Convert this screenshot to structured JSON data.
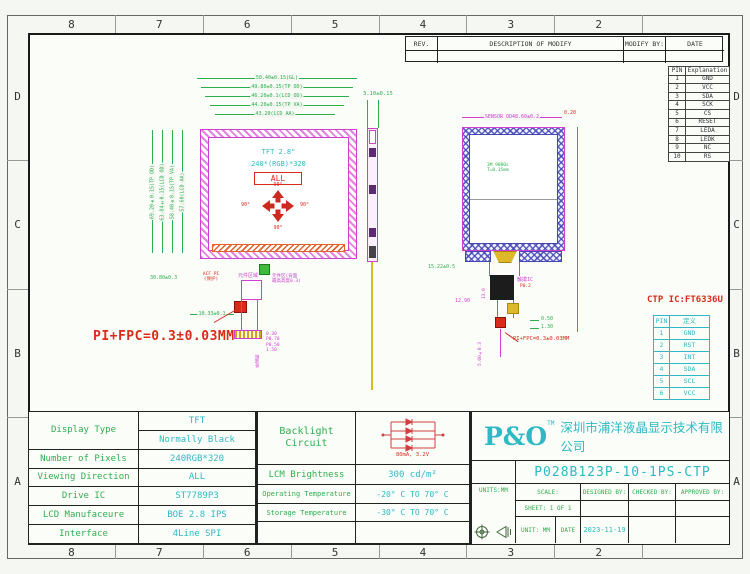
{
  "frame": {
    "zones_top": [
      "8",
      "7",
      "6",
      "5",
      "4",
      "3",
      "2",
      ""
    ],
    "zones_bottom": [
      "8",
      "7",
      "6",
      "5",
      "4",
      "3",
      "2",
      ""
    ],
    "zones_left": [
      "D",
      "C",
      "B",
      "A"
    ],
    "zones_right": [
      "D",
      "C",
      "B",
      "A"
    ]
  },
  "revision_table": {
    "col_rev": "REV.",
    "col_desc": "DESCRIPTION OF MODIFY",
    "col_by": "MODIFY BY:",
    "col_date": "DATE"
  },
  "pin_table": {
    "col_pin": "PIN",
    "col_exp": "Explanation",
    "rows": [
      [
        "1",
        "GND"
      ],
      [
        "2",
        "VCC"
      ],
      [
        "3",
        "SDA"
      ],
      [
        "4",
        "SCK"
      ],
      [
        "5",
        "CS"
      ],
      [
        "6",
        "RESET"
      ],
      [
        "7",
        "LEDA"
      ],
      [
        "8",
        "LEDK"
      ],
      [
        "9",
        "NC"
      ],
      [
        "10",
        "RS"
      ]
    ]
  },
  "front_view": {
    "h_dims": [
      "50.40±0.15(GL)",
      "49.80±0.15(TP OD)",
      "46.20±0.1(LCD OD)",
      "44.20±0.15(TP VA)",
      "43.20(LCD AA)"
    ],
    "v_dims": [
      "69.20±0.15(TP OD)",
      "63.84±0.15(LCD OD)",
      "58.40±0.15(TP VA)",
      "57.60(LCD AA)"
    ],
    "panel_type": "TFT 2.8\"",
    "resolution": "240*(RGB)*320",
    "viewing_badge": "ALL",
    "angle_top": "90°",
    "angle_bottom": "90°",
    "angle_left": "90°",
    "angle_right": "90°",
    "dim_fpc": "10.33±0.1",
    "dim_side": "30.80±0.3",
    "label_acf_line1": "ACF PI",
    "label_acf_line2": "(保护)",
    "label_comp_area": "元件区域",
    "label_comp_back_line1": "元件区(背面",
    "label_comp_back_line2": "最高高度0.3)",
    "label_stiffener": "补强板",
    "fpc_pitch_dims": [
      "0.30",
      "P0.70",
      "P0.50",
      "1.50"
    ],
    "note_pi_fpc": "PI+FPC=0.3±0.03MM"
  },
  "side_view": {
    "dim_thickness": "3.10±0.15"
  },
  "back_view": {
    "dim_sensor": "SENSOR OD48.60±0.2",
    "dim_corner": "0.20",
    "tape_line1": "3M 9080s",
    "tape_line2": "T=0.15mm",
    "dim_fpc_width": "15.22±0.5",
    "dim_ic_height": "13.0",
    "dim_1290": "12.90",
    "label_touch_ic": "触摸IC",
    "dim_pitch": "P0.2",
    "dim_050": "0.50",
    "dim_130": "1.30",
    "dim_tail": "5.00±0.3",
    "note_pi_fpc": "PI+FPC=0.3±0.03MM"
  },
  "ctp": {
    "title": "CTP IC:FT6336U",
    "col_pin": "PIN",
    "col_def": "定义",
    "rows": [
      [
        "1",
        "GND"
      ],
      [
        "2",
        "RST"
      ],
      [
        "3",
        "INT"
      ],
      [
        "4",
        "SDA"
      ],
      [
        "5",
        "SCL"
      ],
      [
        "6",
        "VCC"
      ]
    ]
  },
  "spec": {
    "display_type_label": "Display Type",
    "display_type_value1": "TFT",
    "display_type_value2": "Normally Black",
    "pixels_label": "Number of Pixels",
    "pixels_value": "240RGB*320",
    "viewing_label": "Viewing Direction",
    "viewing_value": "ALL",
    "drive_label": "Drive IC",
    "drive_value": "ST7789P3",
    "mfr_label": "LCD Manufaceure",
    "mfr_value": "BOE 2.8 IPS",
    "interface_label": "Interface",
    "interface_value": "4Line SPI"
  },
  "env": {
    "backlight_line1": "Backlight",
    "backlight_line2": "Circuit",
    "led_rating": "80mA, 3.2V",
    "brightness_label": "LCM Brightness",
    "brightness_value": "300 cd/m²",
    "op_label": "Operating Temperature",
    "op_value": "-20° C TO 70° C",
    "st_label": "Storage Temperature",
    "st_value": "-30° C TO 70° C"
  },
  "title_block": {
    "logo": "P&O",
    "logo_tm": "TM",
    "company": "深圳市浦洋液晶显示技术有限公司",
    "part_number": "P028B123P-10-1PS-CTP",
    "units": "UNITS:MM",
    "scale": "SCALE:",
    "sheet": "SHEET: 1 OF 1",
    "unit": "UNIT: MM",
    "date_label": "DATE",
    "date_value": "2023-11-19",
    "designed": "DESIGNED BY:",
    "checked": "CHECKED BY:",
    "approved": "APPROVED BY:"
  },
  "colors": {
    "green": "#2fae4e",
    "cyan": "#2fb9c4",
    "magenta": "#cf3fd0",
    "red": "#d92a1a",
    "blue": "#4547b5",
    "yellow": "#ddb92a"
  }
}
